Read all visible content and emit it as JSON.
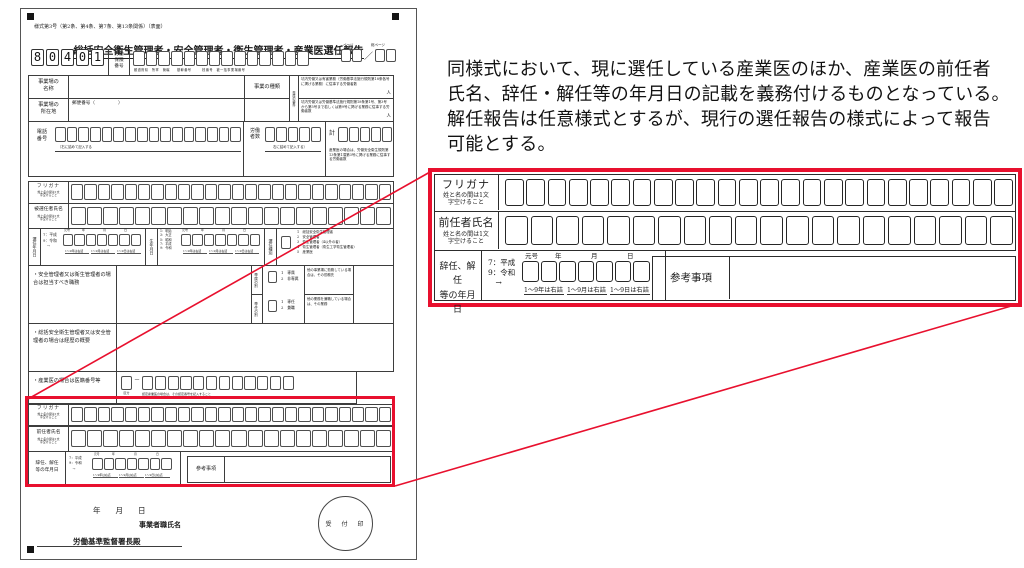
{
  "colors": {
    "highlight_red": "#e8102e"
  },
  "annotation": {
    "line1": "同様式において、現に選任している産業医のほか、産業医の前任者",
    "line2": "氏名、辞任・解任等の年月日の記載を義務付けるものとなっている。",
    "line3": "解任報告は任意様式とするが、現行の選任報告の様式によって報告",
    "line4": "可能とする。"
  },
  "form": {
    "header_note": "様式第3号（第2条、第4条、第7条、第13条関係）（表面）",
    "title": "総括安全衛生管理者・安全管理者・衛生管理者・産業医選任報告",
    "code_digits": [
      "8",
      "0",
      "4",
      "0",
      "1"
    ],
    "labour_insurance": {
      "label": "労働\n保険\n番号",
      "sublabels": "都道府県　所掌　管轄　　基幹番号　　　枝番号　被一括事業場番号"
    },
    "page_counter": {
      "page_label": "ページ",
      "total_label": "総ページ",
      "slash": "／"
    },
    "workplace": {
      "name_label": "事業場の\n名称",
      "address_label": "事業場の\n所在地",
      "postal": "郵便番号（　　　　　）",
      "biz_type_label": "事業の種類",
      "strip_label": "専属の要件",
      "right_row1": "坑内労働又は有害業務（労働基準法施行規則第18条各号に掲げる業務）に従事する労働者数",
      "right_row1_unit": "人",
      "right_row2": "坑内労働又は労働基準法施行規則第18条第1号、第3号から第5号まで若しくは第9号に掲げる業務に従事する労働者数",
      "right_row2_unit": "人"
    },
    "phone": {
      "label": "電話\n番号",
      "fill_note_left": "｛右に詰めて記入する",
      "workers_label": "労働\n者数",
      "fill_note_right": "右に詰めて記入する｝",
      "total_label": "計",
      "sanyoi_note": "産業医の場合は、労働安全衛生規則第13条第1項第3号に掲げる業務に従事する労働者数"
    },
    "furigana": {
      "label": "フリガナ",
      "note": "姓と名の間は1文\n字空けること"
    },
    "appointee": {
      "label": "被選任者氏名"
    },
    "appoint_date": {
      "label": "選任年月日",
      "era": "7：平成\n9：令和\n　→",
      "headers": {
        "gengo": "元号",
        "year": "年",
        "month": "月",
        "day": "日"
      },
      "notes": [
        "1～9年は右詰",
        "1～9月は右詰",
        "1～9日は右詰"
      ]
    },
    "birth_date": {
      "label": "生年月日",
      "era": "1：明治\n3：大正\n5：昭和\n7：平成\n9：令和"
    },
    "appoint_type": {
      "label": "選任種別",
      "options": "1　総括安全衛生管理者\n2　安全管理者\n3　衛生管理者（4以外の者）\n4　衛生管理者（衛生工学衛生管理者）\n5　産業医"
    },
    "duty": {
      "label": "・安全管理者又は衛生管理者の場合は担当すべき職務",
      "senzoku": {
        "label": "専属の別",
        "options": "1　専属\n2　非専属",
        "note": "他の事業場に勤務している場合は、その勤務先"
      },
      "sennin": {
        "label": "専任の別",
        "options": "1　専任\n2　兼職",
        "note": "他の業務を兼職している場合は、その業務"
      }
    },
    "career": {
      "label": "・総括安全衛生管理者又は安全管理者の場合は経歴の概要"
    },
    "iseki": {
      "label": "・産業医の場合は医籍番号等",
      "dash": "－",
      "kubun": "区分",
      "micro_note": "認定産業医の場合は、その認定番号を記入すること"
    },
    "predecessor_section": {
      "furigana_label": "フリガナ",
      "name_label": "前任者氏名",
      "note": "姓と名の間は1文\n字空けること",
      "resign_label": "辞任、解任\n等の年月日",
      "era": "7：平成\n9：令和\n　→",
      "notes": [
        "1～9年は右詰",
        "1～9月は右詰",
        "1～9日は右詰"
      ],
      "reference_label": "参考事項"
    },
    "footer": {
      "date_line": "年　　月　　日",
      "signer": "事業者職氏名",
      "addressee": "労働基準監督署長殿",
      "stamp": "受　付　印"
    }
  },
  "callout": {
    "furigana": {
      "label": "フリガナ",
      "note": "姓と名の間は1文\n字空けること"
    },
    "predecessor": {
      "label": "前任者氏名",
      "note": "姓と名の間は1文\n字空けること"
    },
    "resign": {
      "label": "辞任、解任\n等の年月日",
      "era": "7：平成\n9：令和\n　→",
      "headers": {
        "gengo": "元号",
        "year": "年",
        "month": "月",
        "day": "日"
      },
      "notes": [
        "1～9年は右詰",
        "1～9月は右詰",
        "1～9日は右詰"
      ]
    },
    "reference_label": "参考事項"
  }
}
